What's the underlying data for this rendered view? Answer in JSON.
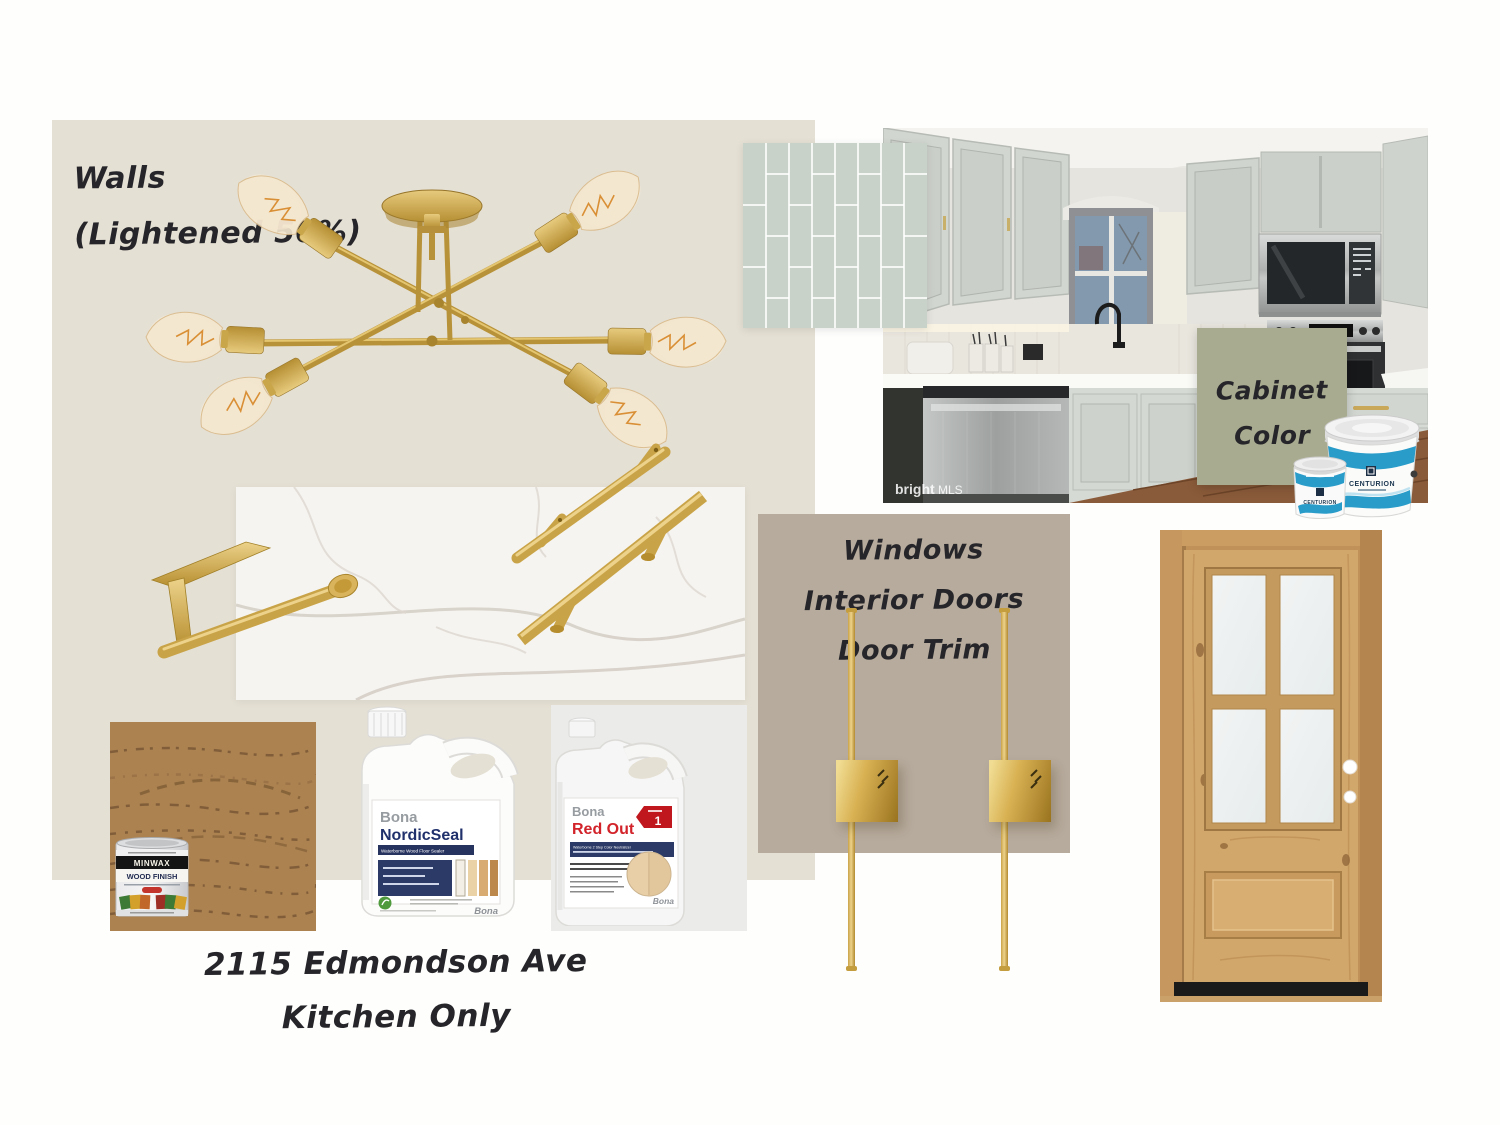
{
  "labels": {
    "walls": [
      "Walls",
      "(Lightened 50%)"
    ],
    "cabinet": [
      "Cabinet",
      "Color"
    ],
    "windows": [
      "Windows",
      "Interior Doors",
      "Door Trim"
    ],
    "address": [
      "2115 Edmondson Ave",
      "Kitchen Only"
    ]
  },
  "watermark": {
    "bold": "bright",
    "light": "MLS"
  },
  "products": {
    "paint": {
      "brand": "CENTURION"
    },
    "minwax": {
      "brand": "MINWAX",
      "product": "WOOD FINISH"
    },
    "nordicseal": {
      "brand": "Bona",
      "product": "NordicSeal",
      "banner": "Waterborne Wood Floor Sealer",
      "logo": "Bona"
    },
    "redout": {
      "brand": "Bona",
      "product": "Red Out",
      "badge": "1",
      "banner": "Waterborne 2 Step Color Neutralizer",
      "logo": "Bona"
    }
  },
  "items": {
    "chandelier": "gold-sputnik-semi-flush-light",
    "kitchen_photo": "kitchen-listing-photo",
    "tile": "vertical-stack-tile-swatch",
    "marble": "white-quartz-countertop-swatch",
    "paper_towel_holder": "brass-paper-towel-holder",
    "pulls": "brass-cabinet-pulls",
    "sconces": "brass-linear-wall-sconces",
    "door": "knotty-alder-4-lite-door",
    "stain": "stained-oak-swatch"
  },
  "colors": {
    "background": "#fefefd",
    "walls_swatch": "#e5e0d4",
    "trim_swatch": "#b7ab9d",
    "cabinet_swatch": "#a9ab90",
    "tile_swatch": "#c9d2c9",
    "brass": "#c9a344",
    "marble": "#f6f4f0",
    "door_wood": "#d2a76b",
    "stain_wood": "#a87e4e",
    "paint_blue": "#2a9cc9",
    "label_navy": "#2b3a66",
    "redout_red": "#d2232a",
    "ink": "#26262a"
  }
}
